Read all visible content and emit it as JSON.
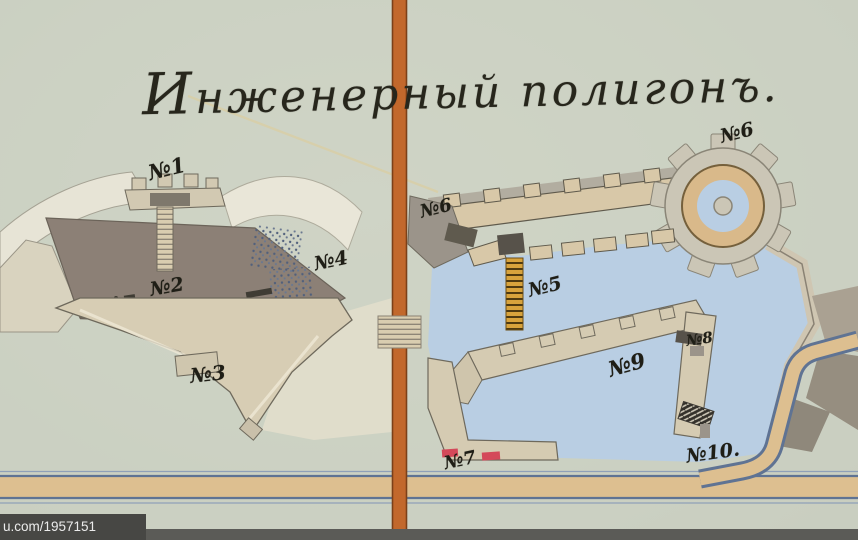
{
  "page": {
    "title": "Инженерный полигонъ.",
    "watermark": "u.com/1957151"
  },
  "map": {
    "labels": [
      {
        "id": "n1",
        "text": "№1"
      },
      {
        "id": "n2",
        "text": "№2"
      },
      {
        "id": "n3",
        "text": "№3"
      },
      {
        "id": "n4",
        "text": "№4"
      },
      {
        "id": "n5",
        "text": "№5"
      },
      {
        "id": "n6-wall",
        "text": "№6"
      },
      {
        "id": "n6-tower",
        "text": "№6"
      },
      {
        "id": "n7",
        "text": "№7"
      },
      {
        "id": "n8",
        "text": "№8"
      },
      {
        "id": "n9",
        "text": "№9"
      },
      {
        "id": "n10",
        "text": "№10."
      }
    ],
    "colors": {
      "paper": "#ccd1c3",
      "fold_stripe": "#c2682c",
      "water": "#b9cee3",
      "wall_tan": "#d8c8a8",
      "rampart_beige": "#d7cdb4",
      "interior_dark": "#8c8076",
      "road_fill": "#ddbf90",
      "road_edge": "#5f7393",
      "red_marker": "#d4495a",
      "gold_ladder": "#d8a33c",
      "ink": "#27261c"
    }
  }
}
